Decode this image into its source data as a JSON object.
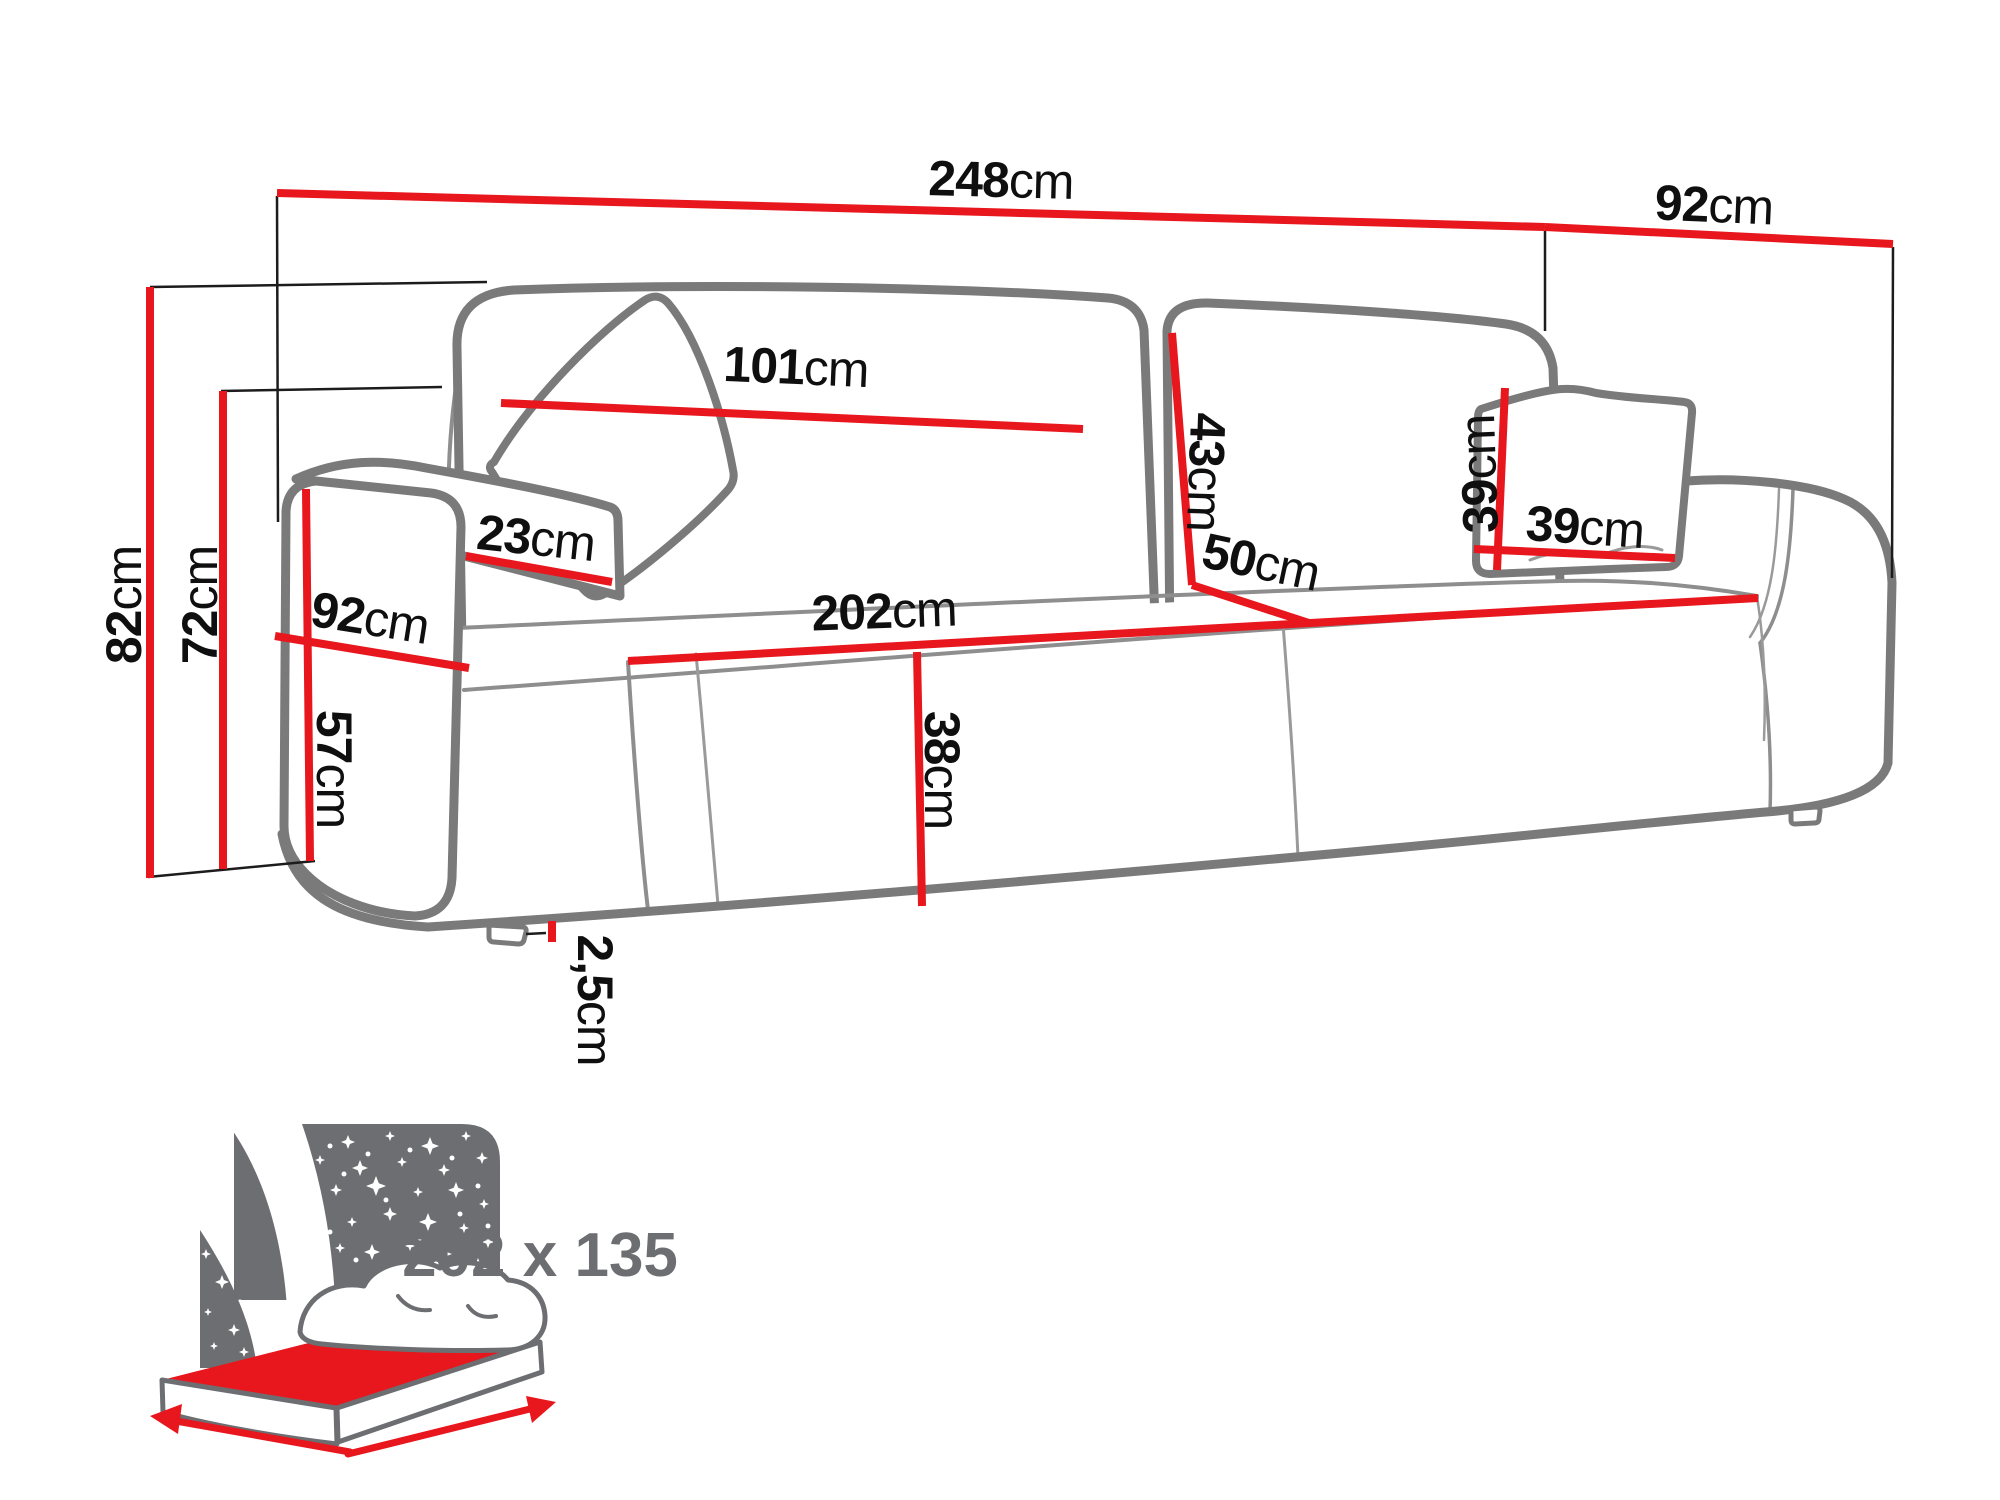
{
  "diagram": {
    "type": "sofa-dimension-diagram",
    "unit_system": "cm"
  },
  "dimensions": {
    "overall_width": {
      "value": "248",
      "unit": "cm"
    },
    "overall_depth": {
      "value": "92",
      "unit": "cm"
    },
    "overall_height": {
      "value": "82",
      "unit": "cm"
    },
    "backrest_height": {
      "value": "72",
      "unit": "cm"
    },
    "back_cushion_width": {
      "value": "101",
      "unit": "cm"
    },
    "back_cushion_height": {
      "value": "43",
      "unit": "cm"
    },
    "armrest_width": {
      "value": "23",
      "unit": "cm"
    },
    "armrest_depth": {
      "value": "92",
      "unit": "cm"
    },
    "armrest_height": {
      "value": "57",
      "unit": "cm"
    },
    "seat_width": {
      "value": "202",
      "unit": "cm"
    },
    "seat_depth": {
      "value": "50",
      "unit": "cm"
    },
    "seat_height": {
      "value": "38",
      "unit": "cm"
    },
    "pillow_width": {
      "value": "39",
      "unit": "cm"
    },
    "pillow_height": {
      "value": "39",
      "unit": "cm"
    },
    "leg_height": {
      "value": "2,5",
      "unit": "cm"
    },
    "sleeping_area": {
      "value": "202 x 135",
      "unit": ""
    }
  },
  "colors": {
    "dimension_line": "#e8161d",
    "extension_line": "#1c1c1c",
    "sofa_outline": "#7a7a7a",
    "label_text": "#0f0f0f",
    "icon_gray": "#6d6e71",
    "background": "#ffffff"
  }
}
